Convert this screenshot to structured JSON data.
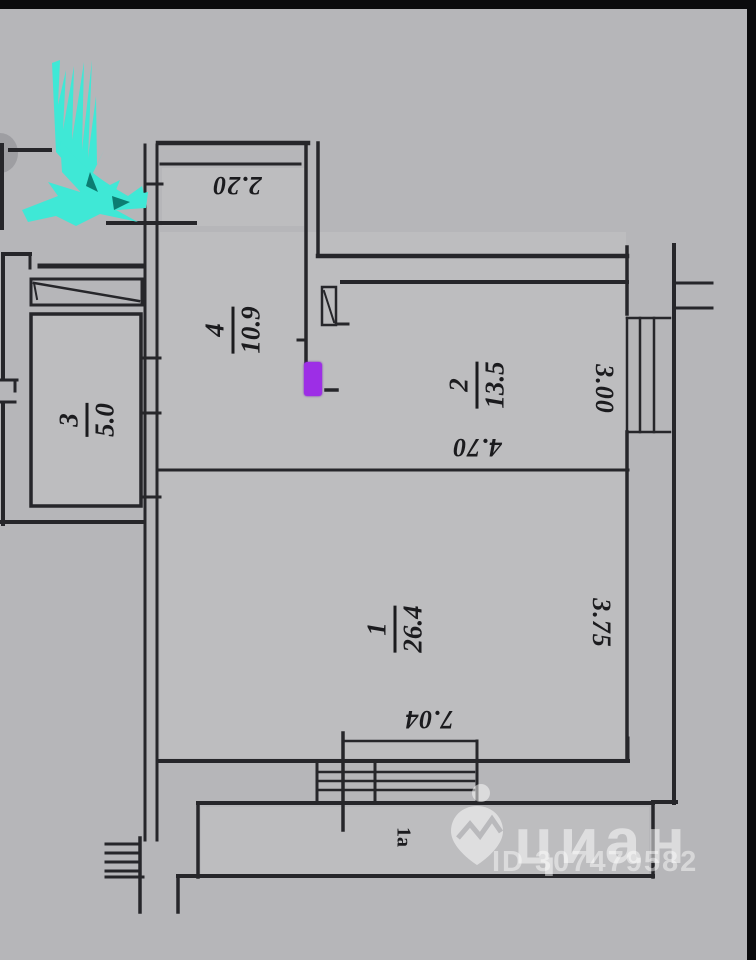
{
  "plan": {
    "rooms": [
      {
        "number": "1",
        "area": "26.4",
        "width_m": "7.04",
        "depth_m": "3.75"
      },
      {
        "number": "2",
        "area": "13.5",
        "width_m": "4.70",
        "depth_m": "3.00"
      },
      {
        "number": "3",
        "area": "5.0"
      },
      {
        "number": "4",
        "area": "10.9"
      }
    ],
    "balcony_top": {
      "width_m": "2.20"
    },
    "balcony_bottom": {
      "label": "1а"
    }
  },
  "watermark": {
    "brand": "циан",
    "listing_id": "ID 307479582"
  },
  "annotations": {
    "highlight_color": "#3fe8d6",
    "marker_color": "#9d2ee6",
    "ink_color": "#26262a",
    "paper_color": "#b6b6b9"
  }
}
